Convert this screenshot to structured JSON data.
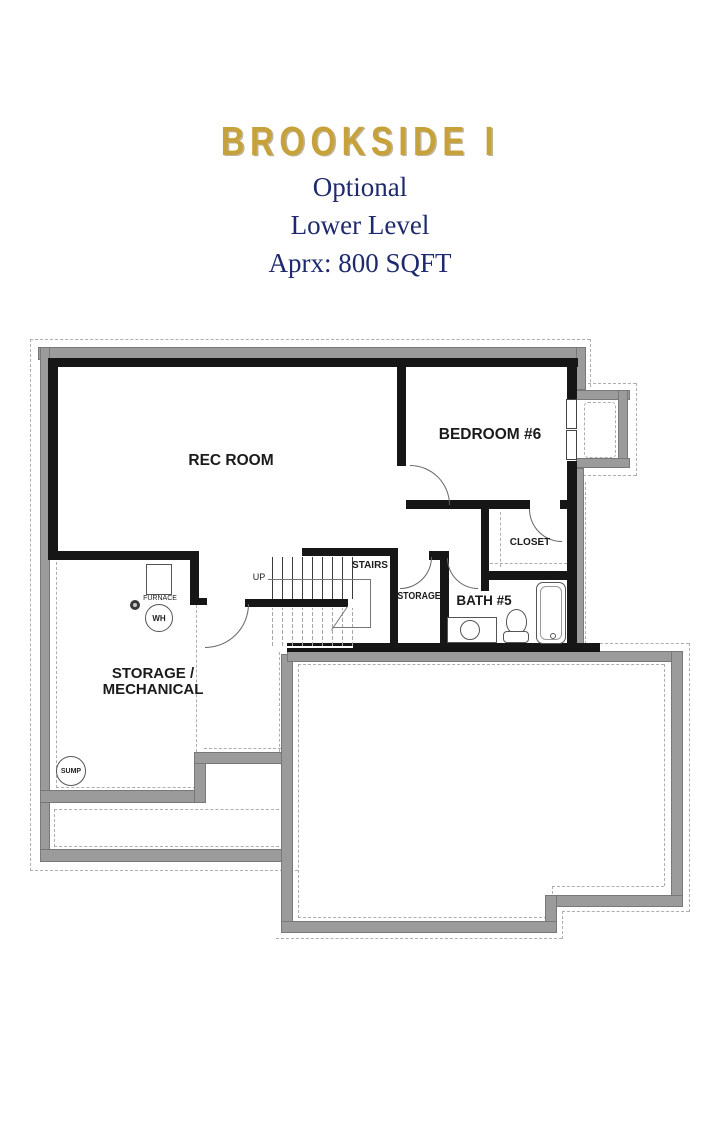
{
  "header": {
    "title": "BROOKSIDE I",
    "line1": "Optional",
    "line2": "Lower Level",
    "line3": "Aprx: 800 SQFT"
  },
  "plan": {
    "rec_room": "REC ROOM",
    "bedroom": "BEDROOM #6",
    "closet": "CLOSET",
    "stairs": "STAIRS",
    "up": "UP",
    "storage": "STORAGE",
    "bath": "BATH #5",
    "storage_mech_1": "STORAGE /",
    "storage_mech_2": "MECHANICAL",
    "furnace": "FURNACE",
    "water_heater": "WH",
    "sump": "SUMP"
  },
  "colors": {
    "title_gold": "#c7a23b",
    "subtitle_navy": "#1e2a6d",
    "wall_black": "#161616",
    "foundation_gray": "#9b9b9b",
    "dashed_gray": "#aeaeae"
  }
}
